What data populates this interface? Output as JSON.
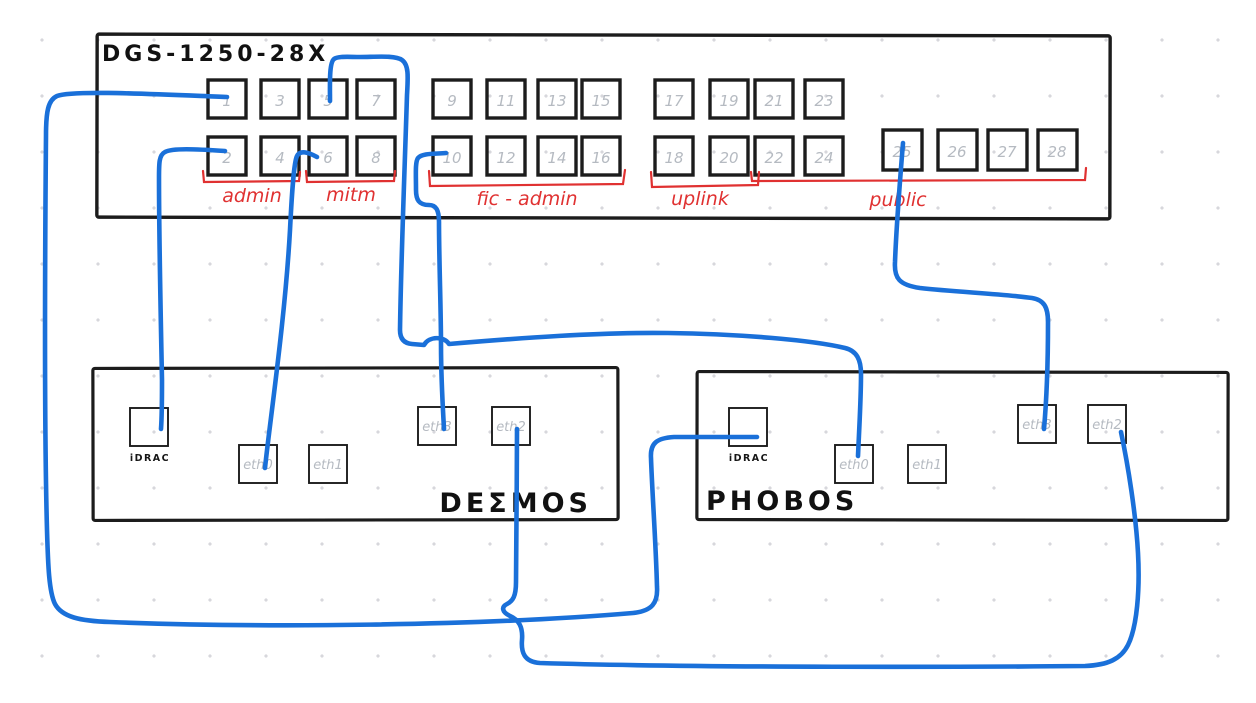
{
  "diagram": {
    "switch": {
      "title": "DGS-1250-28X",
      "ports_top": [
        "1",
        "3",
        "5",
        "7",
        "9",
        "11",
        "13",
        "15",
        "17",
        "19",
        "21",
        "23"
      ],
      "ports_bottom": [
        "2",
        "4",
        "6",
        "8",
        "10",
        "12",
        "14",
        "16",
        "18",
        "20",
        "22",
        "24"
      ],
      "ports_sfp": [
        "25",
        "26",
        "27",
        "28"
      ],
      "groups": [
        {
          "label": "admin"
        },
        {
          "label": "mitm"
        },
        {
          "label": "fic - admin"
        },
        {
          "label": "uplink"
        },
        {
          "label": "public"
        }
      ]
    },
    "servers": [
      {
        "name": "DEΣMOS",
        "ports": [
          "iDRAC",
          "eth0",
          "eth1",
          "eth3",
          "eth2"
        ]
      },
      {
        "name": "PHOBOS",
        "ports": [
          "iDRAC",
          "eth0",
          "eth1",
          "eth3",
          "eth2"
        ]
      }
    ],
    "connections": [
      {
        "from": "switch port 1",
        "to": "PHOBOS iDRAC"
      },
      {
        "from": "switch port 2",
        "to": "DEΣMOS iDRAC"
      },
      {
        "from": "switch port 5",
        "to": "PHOBOS eth0"
      },
      {
        "from": "switch port 6",
        "to": "DEΣMOS eth0"
      },
      {
        "from": "switch port 10",
        "to": "DEΣMOS eth3"
      },
      {
        "from": "switch port 25",
        "to": "PHOBOS eth3"
      },
      {
        "from": "DEΣMOS eth2",
        "to": "PHOBOS eth2"
      }
    ],
    "colors": {
      "cable": "#1a70d9",
      "group_label": "#e03131",
      "ink": "#1c1c1c",
      "port_number": "#b5bac1"
    }
  }
}
